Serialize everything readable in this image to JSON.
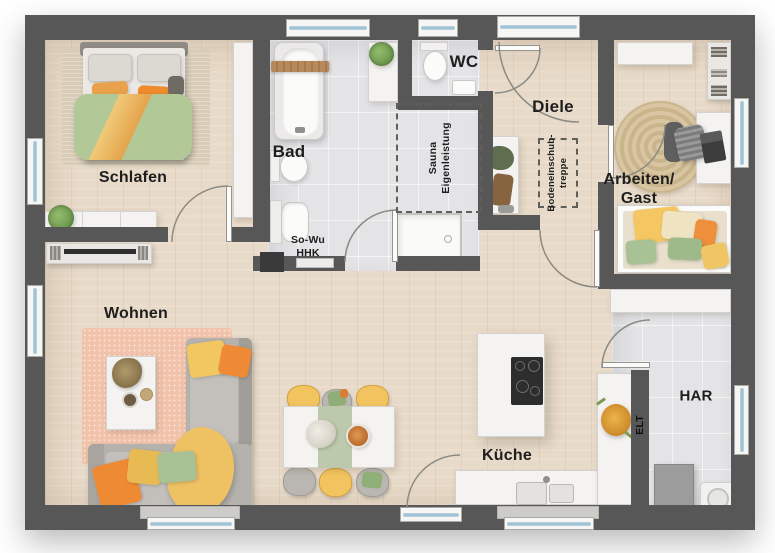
{
  "labels": {
    "schlafen": "Schlafen",
    "bad": "Bad",
    "wc": "WC",
    "diele": "Diele",
    "arbeiten_line1": "Arbeiten/",
    "arbeiten_line2": "Gast",
    "wohnen": "Wohnen",
    "kueche": "Küche",
    "har": "HAR"
  },
  "annotations": {
    "sauna_line1": "Sauna",
    "sauna_line2": "Eigenleistung",
    "attic_line1": "Bodeneinschub-",
    "attic_line2": "treppe",
    "sowu_line1": "So-Wu",
    "sowu_line2": "HHK",
    "elt": "ELT"
  },
  "colors": {
    "wall": "#575757",
    "wood_floor": "#e8dac8",
    "tile_floor": "#e4e4e7",
    "window_glass": "#9ec4da",
    "accent_orange": "#ee8f3a",
    "accent_yellow": "#f2c45f",
    "accent_green": "#a9c295",
    "rug_pink": "#f2c3ab",
    "sofa_gray": "#b5b2ad"
  }
}
